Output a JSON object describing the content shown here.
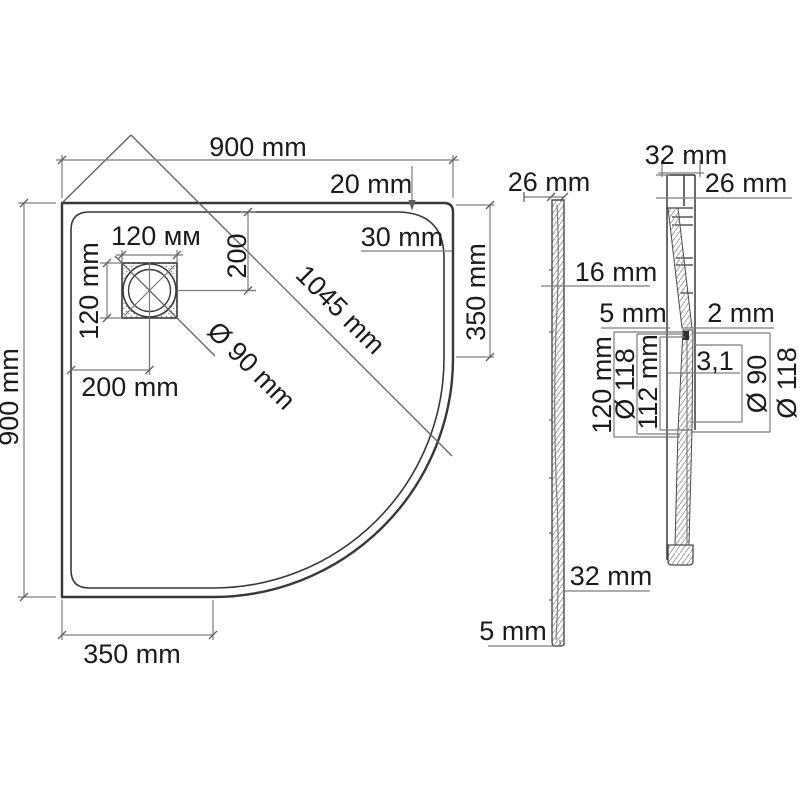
{
  "page": {
    "background": "#ffffff",
    "line_color": "#383838",
    "dim_line_color": "#7c7c7c",
    "text_color": "#1b1b1b"
  },
  "plan_view": {
    "dim_top_width": "900 mm",
    "dim_left_height": "900 mm",
    "dim_rim_top": "20 mm",
    "dim_corner_radius": "30 mm",
    "dim_drain_width": "120 мм",
    "dim_drain_height": "120 mm",
    "dim_drain_center_from_top": "200",
    "dim_diagonal": "1045 mm",
    "dim_drain_diameter": "Ø 90 mm",
    "dim_drain_center_from_left": "200 mm",
    "dim_right_straight_edge": "350 mm",
    "dim_bottom_straight_edge": "350 mm"
  },
  "side_view": {
    "dim_rim_thickness": "26 mm",
    "dim_wall_thickness": "16 mm",
    "dim_base_thickness": "32 mm",
    "dim_foot_height": "5 mm"
  },
  "section_view": {
    "dim_rim_width": "32 mm",
    "dim_rim_height": "26 mm",
    "dim_ledge_left": "5 mm",
    "dim_ledge_right": "2 mm",
    "dim_recess_height": "120 mm",
    "dim_recess_outer_dia": "Ø 118",
    "dim_insert_width": "112 mm",
    "dim_wall_thickness": "3,1",
    "dim_drain_hole_dia": "Ø 90",
    "dim_flange_dia": "Ø 118"
  }
}
